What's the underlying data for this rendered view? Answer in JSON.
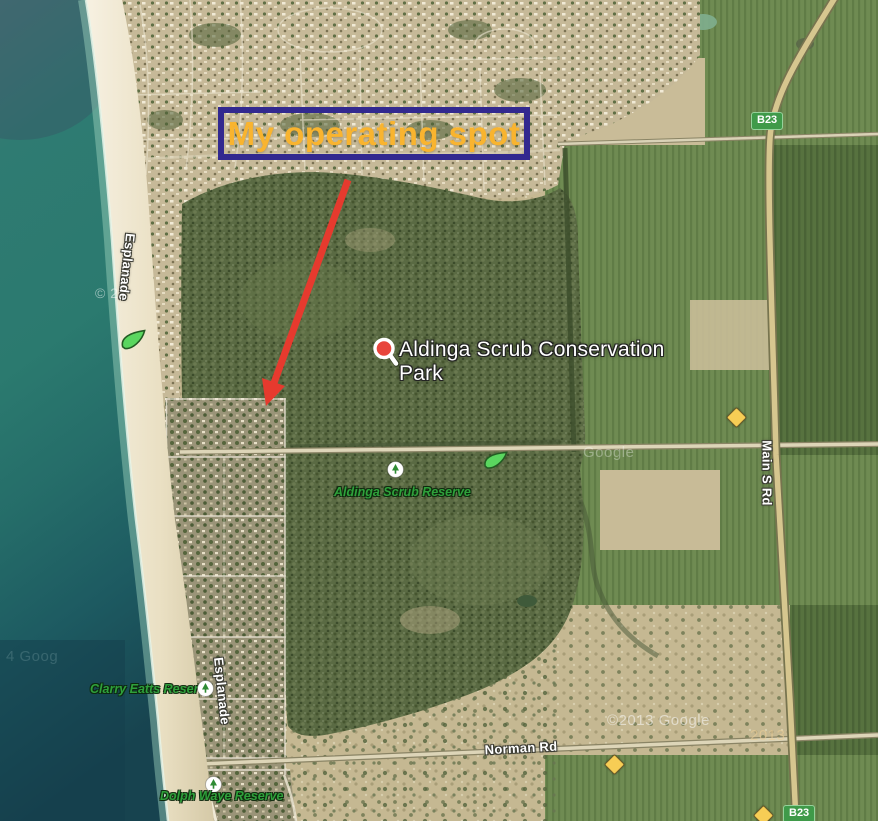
{
  "annotation": {
    "label": "My operating spot",
    "box_border_color": "#32298f",
    "text_color": "#f9b42f",
    "arrow_color": "#e63a2e"
  },
  "poi": {
    "name": "Aldinga Scrub Conservation Park",
    "marker_icon": "search-marker-icon",
    "marker_color": "#e8453c"
  },
  "reserves": [
    {
      "label": "Aldinga Scrub Reserve",
      "icon": "tree-icon"
    },
    {
      "label": "Clarry Eatts Reserve",
      "icon": "tree-icon"
    },
    {
      "label": "Dolph Waye Reserve",
      "icon": "tree-icon"
    }
  ],
  "roads": {
    "esplanade_north": "Esplanade",
    "esplanade_south": "Esplanade",
    "main_south": "Main S Rd",
    "norman": "Norman Rd"
  },
  "route_badges": {
    "north": "B23",
    "south": "B23",
    "color": "#3f9a49"
  },
  "map_icons": {
    "leaf_color": "#5ad65f",
    "diamond_color": "#f7cd55",
    "reserve_label_color": "#2fa13b"
  },
  "watermarks": {
    "copyright": "©2013 Google",
    "year": "2013",
    "google_partial": "Google",
    "left_partial": "4 Goog",
    "coast_partial": "© 20"
  }
}
